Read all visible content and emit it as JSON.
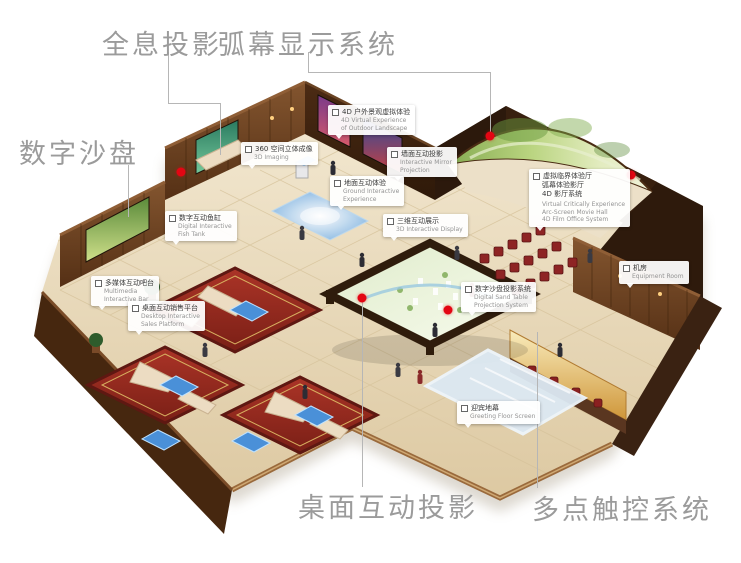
{
  "labels": {
    "holographic": "全息投影",
    "arc_screen": "弧幕显示系统",
    "digital_sand_table": "数字沙盘",
    "desktop_projection": "桌面互动投影",
    "multi_touch": "多点触控系统"
  },
  "callouts": [
    {
      "id": "imaging-360",
      "cn": [
        "360 空间立体成像"
      ],
      "en": [
        "3D Imaging"
      ]
    },
    {
      "id": "outdoor-4d",
      "cn": [
        "4D 户外景观虚拟体验"
      ],
      "en": [
        "4D Virtual Experience",
        "of Outdoor Landscape"
      ]
    },
    {
      "id": "wall-projection",
      "cn": [
        "墙面互动投影"
      ],
      "en": [
        "Interactive Mirror",
        "Projection"
      ]
    },
    {
      "id": "ground-interactive",
      "cn": [
        "地面互动体验"
      ],
      "en": [
        "Ground Interactive",
        "Experience"
      ]
    },
    {
      "id": "display-3d",
      "cn": [
        "三维互动展示"
      ],
      "en": [
        "3D Interactive Display"
      ]
    },
    {
      "id": "fish-tank",
      "cn": [
        "数字互动鱼缸"
      ],
      "en": [
        "Digital Interactive",
        "Fish Tank"
      ]
    },
    {
      "id": "multimedia-bar",
      "cn": [
        "多媒体互动吧台"
      ],
      "en": [
        "Multimedia",
        "Interactive Bar"
      ]
    },
    {
      "id": "desktop-sales",
      "cn": [
        "桌面互动销售平台"
      ],
      "en": [
        "Desktop Interactive",
        "Sales Platform"
      ]
    },
    {
      "id": "dome-hall",
      "cn": [
        "虚拟临界体验厅",
        "弧幕体验影厅",
        "4D 影厅系统"
      ],
      "en": [
        "Virtual Critically Experience",
        "Arc-Screen Movie Hall",
        "4D Film Office System"
      ]
    },
    {
      "id": "sand-projection",
      "cn": [
        "数字沙盘投影系统"
      ],
      "en": [
        "Digital Sand Table",
        "Projection System"
      ]
    },
    {
      "id": "equipment-room",
      "cn": [
        "机房"
      ],
      "en": [
        "Equipment Room"
      ]
    },
    {
      "id": "floor-screen",
      "cn": [
        "迎宾地幕"
      ],
      "en": [
        "Greeting Floor Screen"
      ]
    }
  ],
  "colors": {
    "marker_red": "#e30613",
    "label_gray": "#9b9b9b",
    "leader_line_gray": "#b6b6b6",
    "wall_brown": "#5b3418",
    "floor_beige": "#e9dcc0",
    "dome_green": "#b9d47f",
    "carpet_red": "#a83226",
    "screen_blue": "#4a90d8"
  }
}
